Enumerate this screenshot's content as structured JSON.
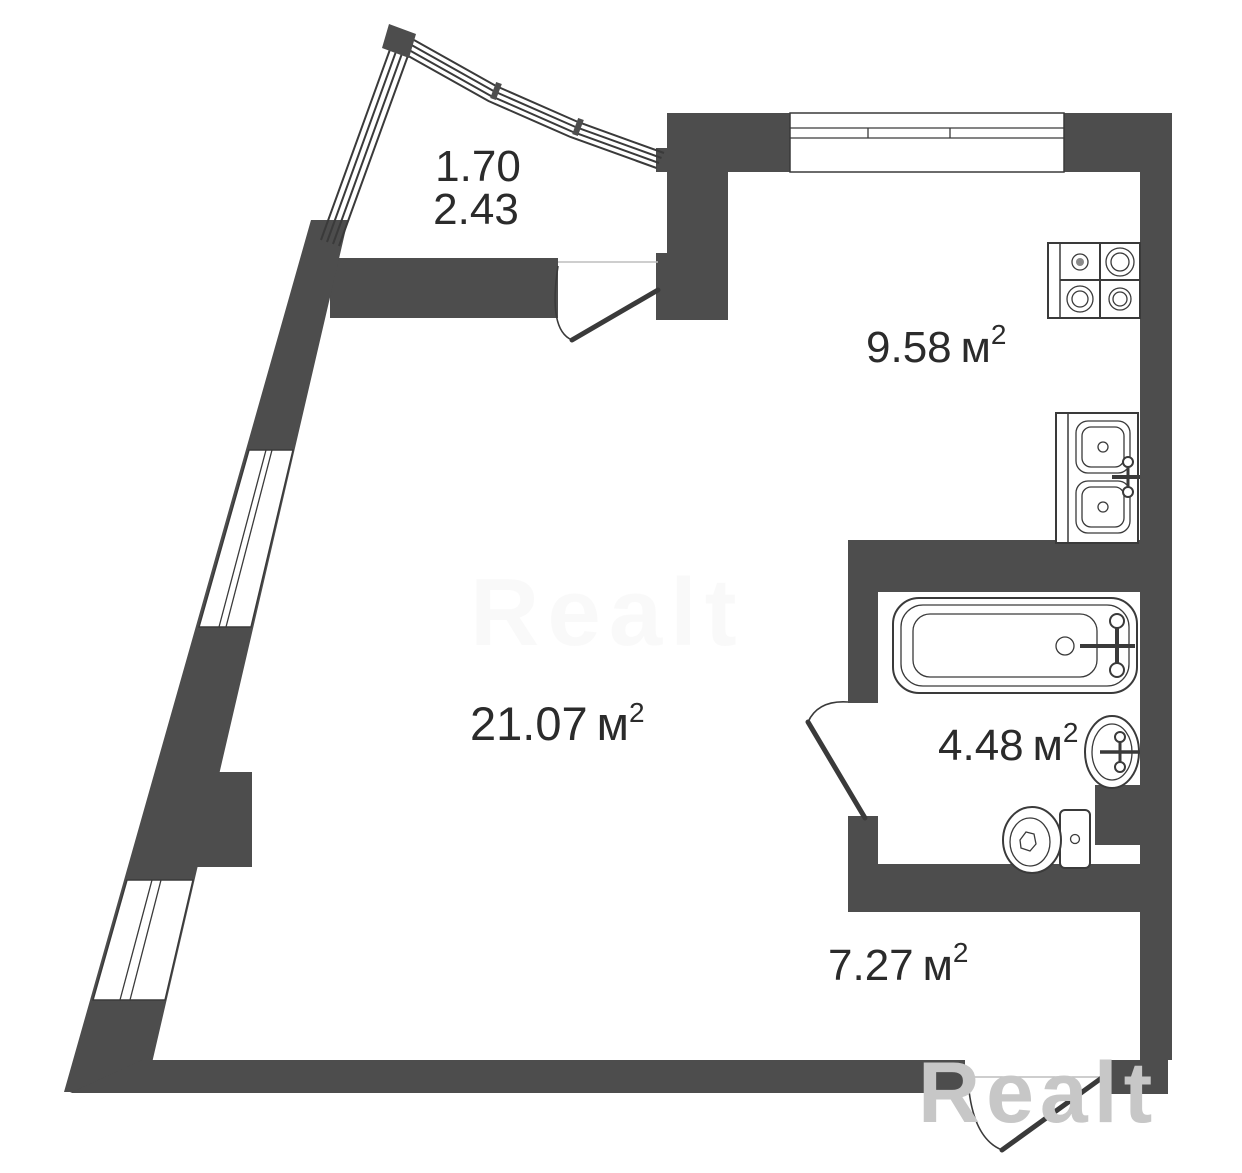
{
  "plan": {
    "type": "apartment-floor-plan",
    "unit": {
      "symbol": "м",
      "sup": "2"
    },
    "rooms": {
      "balcony": {
        "name": "balcony",
        "dim1": "1.70",
        "dim2": "2.43"
      },
      "kitchen": {
        "name": "kitchen",
        "area": "9.58"
      },
      "living": {
        "name": "living-room",
        "area": "21.07"
      },
      "bathroom": {
        "name": "bathroom",
        "area": "4.48"
      },
      "hall": {
        "name": "hallway",
        "area": "7.27"
      }
    },
    "fixtures": [
      "stove-4-burners",
      "double-kitchen-sink",
      "bathtub",
      "washbasin",
      "toilet"
    ],
    "doors": [
      "balcony-door",
      "bathroom-door",
      "entrance-door"
    ],
    "colors": {
      "wall": "#4d4d4d",
      "line": "#3a3a3a",
      "background": "#ffffff",
      "label": "#2b2b2b",
      "watermark": "#c7c7c7"
    }
  },
  "watermark": {
    "text": "Realt"
  }
}
